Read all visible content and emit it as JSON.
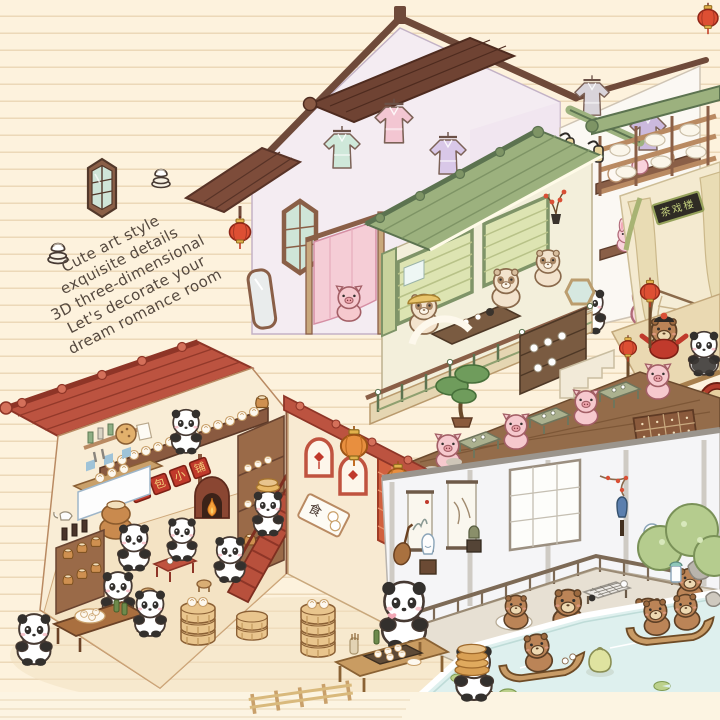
{
  "artwork": {
    "title": "Panda and capybara dollhouse illustration",
    "type": "isometric cutaway miniature rooms drawn on ruled notebook paper",
    "background": {
      "paper": "#fdf2dd",
      "rule_lines": "#ecd8b8"
    }
  },
  "tagline": {
    "lines": [
      "Cute art style",
      "exquisite details",
      "3D three-dimensional",
      "Let's decorate your",
      "dream romance room"
    ],
    "rotation_deg": -27,
    "color": "#55493f"
  },
  "signs": {
    "bakery_plaques": [
      "包",
      "包",
      "小",
      "铺"
    ],
    "food_sign": "食",
    "theater_plaque": "茶戏楼"
  },
  "rooms": [
    {
      "id": "hanfu-attic",
      "label": "hanfu wardrobe attic",
      "wall": "#f4ecf2"
    },
    {
      "id": "tea-balcony",
      "label": "tea house balcony",
      "roof": "#9cb17e"
    },
    {
      "id": "opera-stage",
      "label": "opera stage with fan backdrop",
      "accent": "#dd4f33"
    },
    {
      "id": "tea-terrace",
      "label": "terrace with tea tables",
      "floor": "#946c4a"
    },
    {
      "id": "bun-shop",
      "label": "panda steamed bun shop",
      "roof": "#bc5340",
      "stairs": "#b8503c"
    },
    {
      "id": "scholar-room",
      "label": "scholar study and go deck",
      "wall": "#f5f5f7"
    },
    {
      "id": "boat-pond",
      "label": "boat pond",
      "water": "#def0ee"
    }
  ],
  "characters": [
    "pandas",
    "capybaras",
    "cream capybaras",
    "pigs",
    "rabbit plushes"
  ],
  "palette": {
    "roof_red": "#bc5340",
    "roof_red_dark": "#8e3527",
    "roof_green": "#9cb17e",
    "timber": "#8a5f47",
    "lantern_red": "#dd4f33",
    "lantern_orange": "#e88f3f",
    "pond": "#def0ee",
    "cream_wall": "#f9edd6",
    "lavender_wall": "#f4ecf2"
  }
}
